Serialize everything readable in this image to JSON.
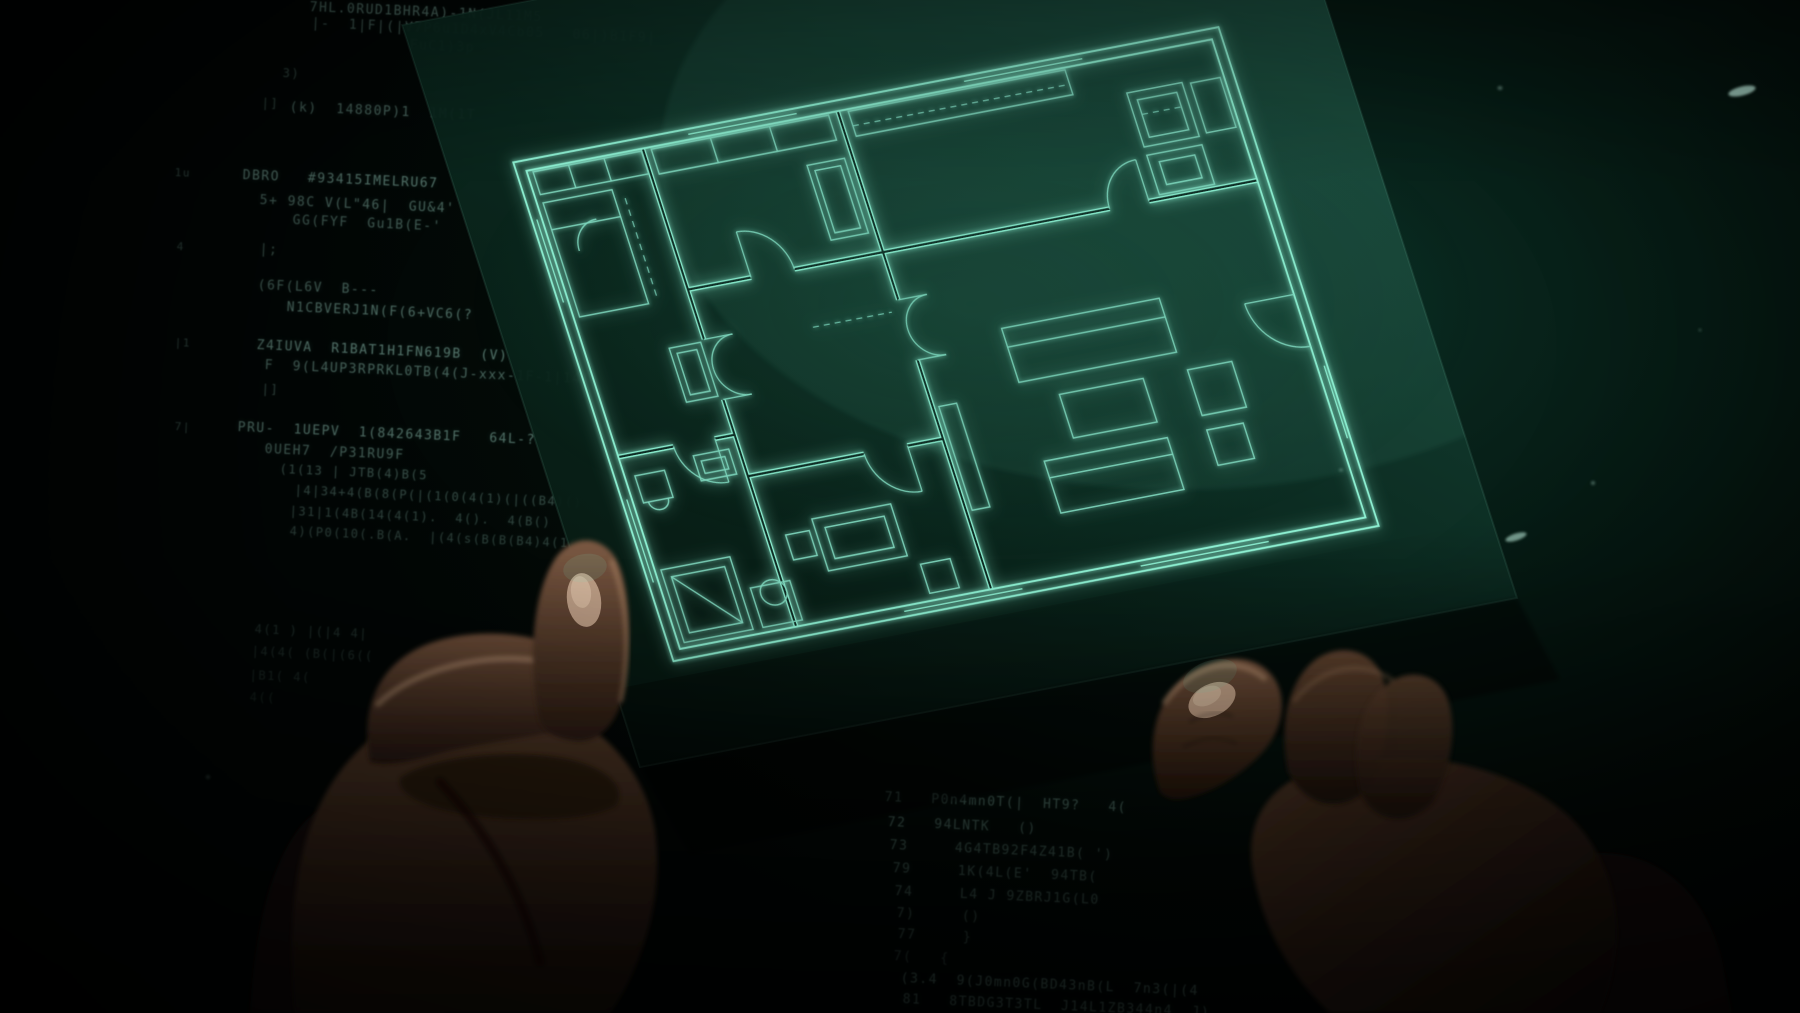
{
  "colors": {
    "background_deep": "#030a07",
    "background_teal": "#0a2d23",
    "sheet_dark": "#0c2a22",
    "line_bright": "#8df0d2",
    "line_dim": "#7fd8bf",
    "code_text": "#9fd8c8",
    "skin_light": "#7a5842",
    "skin_dark": "#20140d",
    "nail": "#c9ab92",
    "speck": "#bff0e0"
  },
  "sheet": {
    "transform": "matrix(0.985 -0.189 0.333 1.037 508 159)"
  },
  "plan": {
    "viewbox": "0 0 724 489",
    "border": [
      "M4,4 H720 V485 H4 Z",
      "M14,14 H710 V475 H14 Z"
    ],
    "walls": [
      "M132,14 V198",
      "M132,256 V475",
      "M330,14 V196",
      "M330,254 V475",
      "M330,150 H560",
      "M600,150 H710",
      "M14,290 H70",
      "M112,290 H132",
      "M132,150 H196",
      "M240,150 H330",
      "M132,330 H250",
      "M294,330 H330"
    ],
    "thin": [
      "M20,16 H130 V38 H20 Z",
      "M56,16 V38",
      "M92,16 V38",
      "M20,46 H90 V156 H20 Z",
      "M20,72 H90",
      "M96,200 H128 V252 H96 Z",
      "M102,206 H122 V246 H102 Z",
      "M24,310 H54 V336 H24 Z",
      "M29,336 a10,9 0 1 0 20,0",
      "M86,302 H122 V326 H86 Z",
      "M92,308 H116 V320 H92 Z",
      "M20,400 H90 V470 H20 Z",
      "M28,408 H82 V462 H28 Z",
      "M28,408 L82,462",
      "M100,432 H140 V470 H100 Z",
      "M108,440 a13,12 0 1 0 26,0 a13,12 0 1 0 -26,0",
      "M140,16 H320 V40 H140 Z",
      "M200,16 V40",
      "M260,16 V40",
      "M284,58 H322 V130 H284 Z",
      "M290,64 H316 V124 H290 Z",
      "M180,380 H260 V430 H180 Z",
      "M190,390 H250 V420 H190 Z",
      "M150,390 H174 V414 H150 Z",
      "M270,440 H300 V468 H270 Z",
      "M340,16 H560 V40 H340 Z",
      "M612,48 H668 V100 H612 Z",
      "M620,56 H660 V92 H620 Z",
      "M612,108 H668 V146 H612 Z",
      "M622,116 H658 V138 H622 Z",
      "M676,50 H706 V98 H676 Z",
      "M420,240 H580 V292 H420 Z",
      "M420,258 H580",
      "M455,310 H540 V352 H455 Z",
      "M420,368 H545 V418 H420 Z",
      "M420,384 H545",
      "M585,310 H630 V354 H585 Z",
      "M585,368 H622 V402 H585 Z",
      "M336,300 H354 V400 H336 Z"
    ],
    "arcs": [
      "M161,198 A29,29 0 0 0 132,227",
      "M161,256 A29,29 0 0 1 132,227",
      "M132,198 H161",
      "M132,256 H161",
      "M359,196 A29,29 0 0 0 330,225",
      "M359,254 A29,29 0 0 1 330,225",
      "M330,196 H359",
      "M330,254 H359",
      "M70,290 A42,42 0 0 0 112,332",
      "M112,290 V332",
      "M240,150 A44,44 0 0 0 196,106",
      "M196,150 V106",
      "M250,330 A44,44 0 0 0 294,374",
      "M294,330 V374",
      "M560,150 A40,40 0 0 1 600,110",
      "M600,150 V110",
      "M660,260 A50,50 0 0 0 710,310",
      "M710,260 H660",
      "M40,96 A26,26 0 0 1 66,70"
    ],
    "windows": [
      "M180,9 H290",
      "M460,9 H580",
      "M717,330 V400",
      "M240,480 H360",
      "M480,480 H610",
      "M9,60 V140",
      "M9,330 V410"
    ],
    "dashes": [
      "M100,56 V150",
      "M340,30 H556",
      "M620,70 H660",
      "M240,206 H320"
    ]
  },
  "hands": {
    "left": [
      {
        "d": "M250,1013 L445,1013 C436,928 422,878 400,843 C370,798 328,790 298,830 C268,870 254,938 250,1013 Z",
        "fill": "#170e09",
        "op": 1,
        "soft": true
      },
      {
        "d": "M295,1013 C285,900 300,820 345,765 C395,705 470,680 535,700 C600,720 645,770 655,830 C665,900 640,970 610,1013 Z",
        "fill": "url(#gPalmL)",
        "op": 1,
        "soft": true
      },
      {
        "d": "M400,778 C430,755 520,748 572,760 C612,770 627,790 616,806 C580,826 478,822 430,806 C409,798 397,789 400,778 Z",
        "fill": "#2a1a10",
        "op": 1,
        "soft": true
      },
      {
        "d": "M370,762 C358,700 385,655 440,640 C500,624 566,640 601,668 C619,684 619,707 600,717 C558,737 480,741 430,756 C405,763 383,766 370,762 Z",
        "fill": "url(#gIndexL)",
        "op": 1,
        "soft": true
      },
      {
        "d": "M378,704 C420,664 502,648 566,666",
        "fill": "none",
        "stroke": "rgba(205,165,130,0.45)",
        "sw": 6,
        "soft": true
      },
      {
        "d": "M540,722 C527,660 533,598 552,564 C565,539 593,532 611,552 C629,572 633,630 625,686 C619,722 601,743 576,741 C557,739 546,733 540,722 Z",
        "fill": "url(#gThumbL)",
        "op": 1,
        "soft": true
      },
      {
        "ellipse": true,
        "cx": 584,
        "cy": 600,
        "rx": 17,
        "ry": 27,
        "rot": -8,
        "fill": "#c4a58d",
        "op": 0.9
      },
      {
        "ellipse": true,
        "cx": 581,
        "cy": 592,
        "rx": 10,
        "ry": 16,
        "rot": -8,
        "fill": "#e2c6ad",
        "op": 0.55
      },
      {
        "d": "M612,562 C628,602 630,652 621,700",
        "fill": "none",
        "stroke": "rgba(190,150,115,0.4)",
        "sw": 5,
        "soft": true
      },
      {
        "ellipse": true,
        "cx": 585,
        "cy": 568,
        "rx": 22,
        "ry": 14,
        "rot": -10,
        "fill": "rgba(120,220,190,0.12)",
        "op": 1
      },
      {
        "d": "M440,782 C478,822 520,882 540,962",
        "fill": "none",
        "stroke": "rgba(15,8,5,0.6)",
        "sw": 9,
        "soft": true
      }
    ],
    "right": [
      {
        "d": "M1430,1013 C1450,930 1492,878 1562,858 C1642,838 1702,880 1722,960 L1732,1013 Z",
        "fill": "#140c08",
        "op": 1,
        "soft": true
      },
      {
        "d": "M1255,882 C1240,820 1270,780 1330,765 C1420,743 1532,770 1582,830 C1622,880 1627,950 1600,1013 L1330,1013 C1290,975 1266,932 1255,882 Z",
        "fill": "url(#gHandR)",
        "op": 1,
        "soft": true
      },
      {
        "d": "M1288,772 C1278,720 1290,680 1315,660 C1340,642 1372,650 1382,676 C1394,706 1386,752 1370,786 C1348,812 1308,812 1288,772 Z",
        "fill": "url(#gFingR)",
        "op": 1,
        "soft": true,
        "clip": true
      },
      {
        "d": "M1360,792 C1349,740 1362,700 1390,682 C1413,667 1440,676 1448,700 C1458,730 1450,772 1433,802 C1410,827 1374,824 1360,792 Z",
        "fill": "url(#gFingR)",
        "op": 0.9,
        "soft": true,
        "clip": true
      },
      {
        "d": "M1295,700 C1320,668 1360,658 1392,680",
        "fill": "none",
        "stroke": "rgba(150,115,85,0.35)",
        "sw": 5,
        "soft": true,
        "clip": true
      },
      {
        "d": "M1160,792 C1147,756 1151,714 1175,687 C1201,657 1247,649 1269,672 C1289,692 1286,730 1258,757 C1228,787 1188,802 1172,799 C1165,797 1162,795 1160,792 Z",
        "fill": "url(#gThumbR)",
        "op": 1,
        "soft": true
      },
      {
        "ellipse": true,
        "cx": 1212,
        "cy": 700,
        "rx": 25,
        "ry": 16,
        "rot": -26,
        "fill": "#c9a88e",
        "op": 0.9
      },
      {
        "ellipse": true,
        "cx": 1207,
        "cy": 696,
        "rx": 15,
        "ry": 9,
        "rot": -26,
        "fill": "#e6cbb0",
        "op": 0.5
      },
      {
        "d": "M1165,702 C1190,665 1236,654 1264,678",
        "fill": "none",
        "stroke": "rgba(200,160,125,0.45)",
        "sw": 6,
        "soft": true
      },
      {
        "d": "M1190,722 q22,-13 42,-6",
        "fill": "none",
        "stroke": "rgba(0,0,0,0.35)",
        "sw": 2.5,
        "soft": true
      },
      {
        "d": "M1184,747 q26,-15 52,-4",
        "fill": "none",
        "stroke": "rgba(0,0,0,0.3)",
        "sw": 2.5,
        "soft": true
      },
      {
        "ellipse": true,
        "cx": 1210,
        "cy": 676,
        "rx": 28,
        "ry": 15,
        "rot": -20,
        "fill": "rgba(120,220,190,0.12)",
        "op": 1
      }
    ]
  },
  "specks": [
    {
      "cx": 1742,
      "cy": 91,
      "rx": 14,
      "ry": 4.5,
      "rot": -14,
      "o": 0.85
    },
    {
      "cx": 1500,
      "cy": 88,
      "rx": 2.5,
      "ry": 2,
      "rot": 0,
      "o": 0.4
    },
    {
      "cx": 1516,
      "cy": 537,
      "rx": 11,
      "ry": 3.5,
      "rot": -18,
      "o": 0.6
    },
    {
      "cx": 1593,
      "cy": 483,
      "rx": 2,
      "ry": 2,
      "rot": 0,
      "o": 0.35
    },
    {
      "cx": 1341,
      "cy": 470,
      "rx": 2,
      "ry": 1.5,
      "rot": 0,
      "o": 0.3
    },
    {
      "cx": 208,
      "cy": 777,
      "rx": 2,
      "ry": 2,
      "rot": 0,
      "o": 0.2
    },
    {
      "cx": 1700,
      "cy": 330,
      "rx": 1.5,
      "ry": 1.5,
      "rot": 0,
      "o": 0.25
    }
  ],
  "code": {
    "lines": [
      {
        "x": 310,
        "y": 0,
        "t": "7HL.0RUD1BHR4A)-1N(JL11M5",
        "o": 0.5,
        "s": 13
      },
      {
        "x": 312,
        "y": 16,
        "t": "|-  1|F|(|V7P6u1D4xV4Cb05   06|)B1F9|",
        "o": 0.42,
        "s": 13
      },
      {
        "x": 410,
        "y": 38,
        "t": "FuC1)3p",
        "o": 0.38,
        "s": 13
      },
      {
        "x": 283,
        "y": 66,
        "t": "3)",
        "o": 0.3,
        "s": 12
      },
      {
        "x": 290,
        "y": 100,
        "t": "(k)  14880P)1  1M(1T",
        "o": 0.45,
        "s": 13
      },
      {
        "x": 262,
        "y": 96,
        "t": "|]",
        "o": 0.3,
        "s": 12
      },
      {
        "x": 175,
        "y": 166,
        "t": "1u",
        "o": 0.3,
        "s": 11
      },
      {
        "x": 243,
        "y": 168,
        "t": "DBRO   #93415IMELRU67",
        "o": 0.5,
        "s": 13
      },
      {
        "x": 260,
        "y": 193,
        "t": "5+ 98C V(L\"46|  GU&4'",
        "o": 0.42,
        "s": 13
      },
      {
        "x": 293,
        "y": 213,
        "t": "GG(FYF  Gu1B(E-'",
        "o": 0.38,
        "s": 13
      },
      {
        "x": 177,
        "y": 240,
        "t": "4",
        "o": 0.28,
        "s": 11
      },
      {
        "x": 260,
        "y": 242,
        "t": "|;",
        "o": 0.34,
        "s": 13
      },
      {
        "x": 258,
        "y": 278,
        "t": "(6F(L6V  B---",
        "o": 0.4,
        "s": 13
      },
      {
        "x": 287,
        "y": 300,
        "t": "N1CBVERJ1N(F(6+VC6(?",
        "o": 0.45,
        "s": 13
      },
      {
        "x": 175,
        "y": 336,
        "t": "|1",
        "o": 0.28,
        "s": 11
      },
      {
        "x": 257,
        "y": 338,
        "t": "Z4IUVA  R1BAT1H1FN619B  (V)",
        "o": 0.5,
        "s": 13
      },
      {
        "x": 265,
        "y": 358,
        "t": "F  9(L4UP3RPRKL0TB(4(J-xxx-1F-1|14|",
        "o": 0.42,
        "s": 13
      },
      {
        "x": 262,
        "y": 382,
        "t": "|]",
        "o": 0.3,
        "s": 12
      },
      {
        "x": 175,
        "y": 420,
        "t": "7|",
        "o": 0.28,
        "s": 11
      },
      {
        "x": 238,
        "y": 420,
        "t": "PRU-  1UEPV  1(842643B1F   64L-?",
        "o": 0.48,
        "s": 13
      },
      {
        "x": 265,
        "y": 442,
        "t": "0UEH7  /P31RU9F",
        "o": 0.4,
        "s": 13
      },
      {
        "x": 280,
        "y": 462,
        "t": "(1(13 | JTB(4)B(5",
        "o": 0.33,
        "s": 12
      },
      {
        "x": 295,
        "y": 483,
        "t": "|4|34+4(B(8(P(|(1(0(4(1)(|((B4)()",
        "o": 0.3,
        "s": 12
      },
      {
        "x": 290,
        "y": 504,
        "t": "|31|1(4B(14(4(1).  4().  4(B()",
        "o": 0.28,
        "s": 12
      },
      {
        "x": 290,
        "y": 524,
        "t": "4)(P0(10(.B(A.  |(4(s(B(B(B4)4(1(4)",
        "o": 0.26,
        "s": 12
      },
      {
        "x": 255,
        "y": 622,
        "t": "4(1 ) |(|4 4|",
        "o": 0.18,
        "s": 12
      },
      {
        "x": 252,
        "y": 644,
        "t": "|4(4( (B(|(6((",
        "o": 0.16,
        "s": 12
      },
      {
        "x": 250,
        "y": 668,
        "t": "|B1( 4(",
        "o": 0.15,
        "s": 12
      },
      {
        "x": 250,
        "y": 690,
        "t": "4((",
        "o": 0.12,
        "s": 12
      },
      {
        "x": 885,
        "y": 790,
        "t": "71   P0n4mn0T(|  HT9?   4(",
        "o": 0.42,
        "s": 13
      },
      {
        "x": 888,
        "y": 815,
        "t": "72   94LNTK   ()",
        "o": 0.38,
        "s": 13
      },
      {
        "x": 890,
        "y": 838,
        "t": "73     4G4TB92F4Z41B( ')",
        "o": 0.35,
        "s": 13
      },
      {
        "x": 893,
        "y": 861,
        "t": "79     1K(4L(E'  94TB(",
        "o": 0.33,
        "s": 13
      },
      {
        "x": 895,
        "y": 884,
        "t": "74     L4 J 9ZBRJ1G(L0",
        "o": 0.33,
        "s": 13
      },
      {
        "x": 897,
        "y": 906,
        "t": "7)     ()",
        "o": 0.3,
        "s": 13
      },
      {
        "x": 898,
        "y": 927,
        "t": "77     }",
        "o": 0.3,
        "s": 13
      },
      {
        "x": 894,
        "y": 949,
        "t": "7(   {",
        "o": 0.25,
        "s": 13
      },
      {
        "x": 901,
        "y": 971,
        "t": "(3.4  9(J0mn0G(BD43nB(L  7n3(|(4",
        "o": 0.42,
        "s": 13
      },
      {
        "x": 903,
        "y": 992,
        "t": "81   8TBDG3T3TL  J14L1ZB344n4  J)",
        "o": 0.38,
        "s": 13
      }
    ]
  }
}
